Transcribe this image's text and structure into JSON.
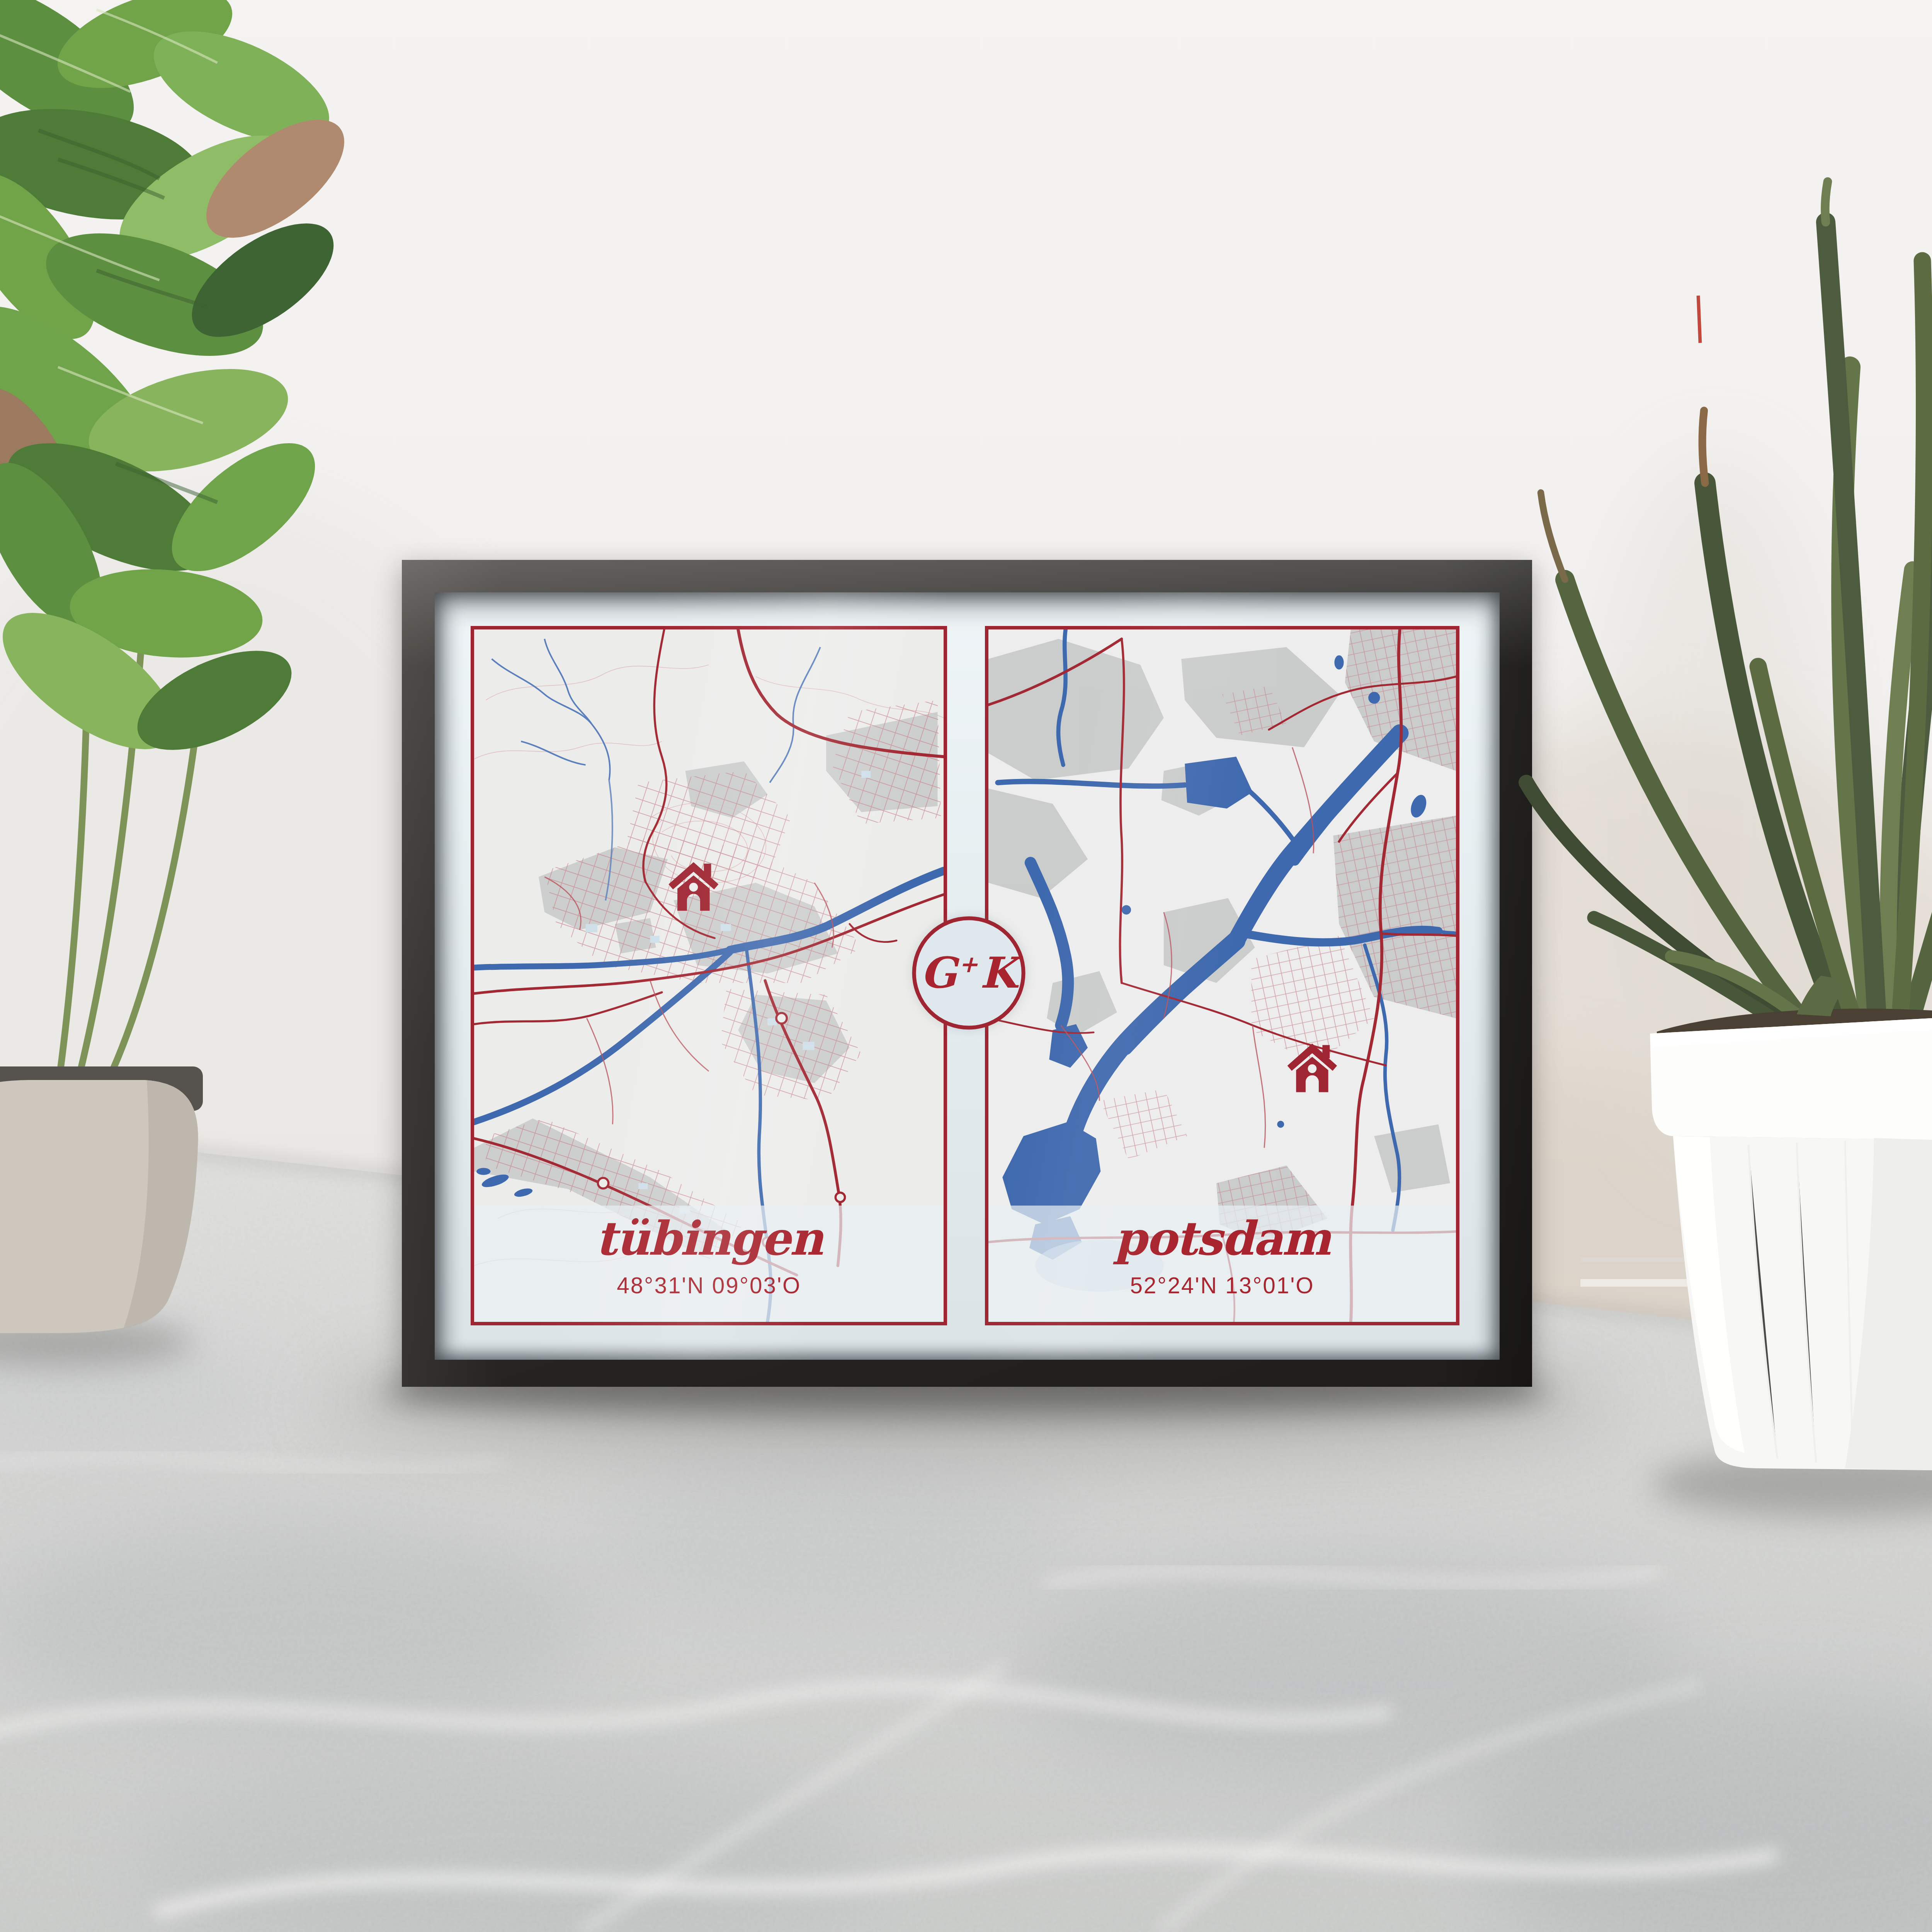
{
  "scene": {
    "description": "Framed two-city couple map print leaning against a wall on a marble floor between two potted plants"
  },
  "poster": {
    "monogram": {
      "left": "G",
      "plus": "+",
      "right": "K",
      "full": "G+K"
    },
    "panels": [
      {
        "id": "tuebingen",
        "city": "t\u00fcbingen",
        "coordinates": "48\u00b031'N 09\u00b003'O",
        "marker": "home-icon"
      },
      {
        "id": "potsdam",
        "city": "potsdam",
        "coordinates": "52\u00b024'N 13\u00b001'O",
        "marker": "home-icon"
      }
    ],
    "colors": {
      "accent_red": "#9e2531",
      "text_red": "#a8242e",
      "water_blue": "#3f69ae",
      "map_background": "#ecedec",
      "urban_gray": "#c7c9c8",
      "poster_background": "#e3ebee",
      "frame_black": "#2b2a28",
      "wall": "#f1f0ee",
      "floor_gray": "#d2d3d1"
    }
  }
}
